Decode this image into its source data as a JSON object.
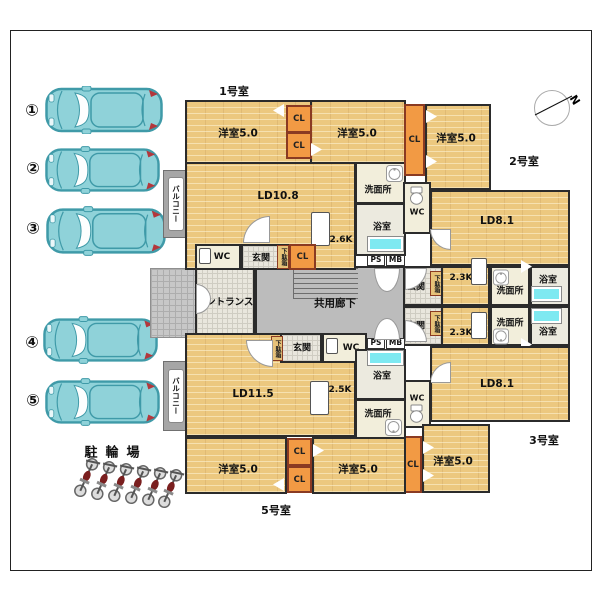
{
  "colors": {
    "room_tan": "#ecc87f",
    "closet_orange": "#f29a44",
    "closet_border": "#8a3a22",
    "tub_cyan": "#7ee9f1",
    "car_teal": "#8fd2d9",
    "car_outline": "#3f9aa8",
    "corridor_gray": "#bcbcbc",
    "balcony_gray": "#a6a6a6",
    "wall": "#2b2b2b",
    "bike_seat_red": "#7a1f1f"
  },
  "parking": {
    "bicycle_label": "駐輪場",
    "bicycle_count": 6,
    "stalls": [
      "①",
      "②",
      "③",
      "④",
      "⑤"
    ]
  },
  "compass": {
    "north": "N"
  },
  "common": {
    "entrance": "エントランス",
    "corridor": "共用廊下",
    "balcony": "バルコニー"
  },
  "unit1": {
    "name": "1号室",
    "bed1": "洋室5.0",
    "bed2": "洋室5.0",
    "ld": "LD10.8",
    "kitchen": "2.6K",
    "washroom": "洗面所",
    "bath": "浴室",
    "wc": "WC",
    "genkan": "玄関",
    "getabako": "下駄箱",
    "cl": "CL",
    "ps": "PS",
    "mb": "MB"
  },
  "unit2": {
    "name": "2号室",
    "bed": "洋室5.0",
    "ld": "LD8.1",
    "kitchen": "2.3K",
    "washroom": "洗面所",
    "bath": "浴室",
    "wc": "WC",
    "genkan": "玄関",
    "getabako": "下駄箱",
    "cl": "CL"
  },
  "unit3": {
    "name": "3号室",
    "bed": "洋室5.0",
    "ld": "LD8.1",
    "kitchen": "2.3K",
    "washroom": "洗面所",
    "bath": "浴室",
    "wc": "WC",
    "genkan": "玄関",
    "getabako": "下駄箱",
    "cl": "CL"
  },
  "unit5": {
    "name": "5号室",
    "bed1": "洋室5.0",
    "bed2": "洋室5.0",
    "ld": "LD11.5",
    "kitchen": "2.5K",
    "washroom": "洗面所",
    "bath": "浴室",
    "wc": "WC",
    "genkan": "玄関",
    "getabako": "下駄箱",
    "cl": "CL",
    "ps": "PS",
    "mb": "MB"
  }
}
